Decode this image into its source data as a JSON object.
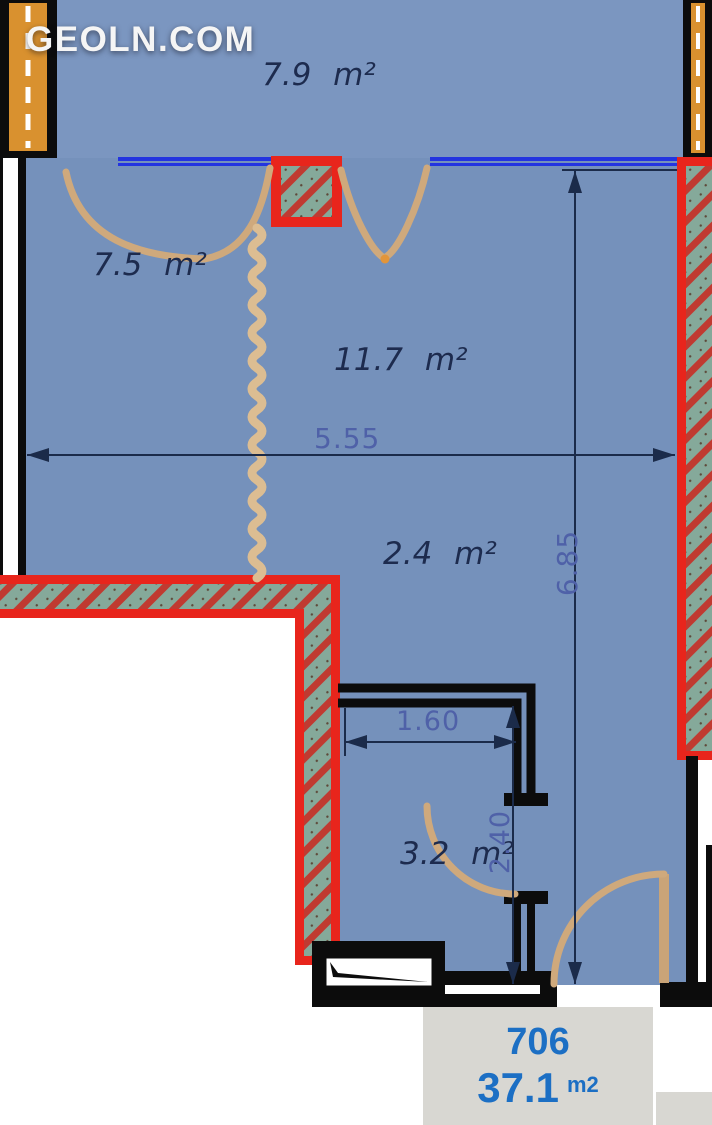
{
  "watermark": "GEOLN.COM",
  "rooms": [
    {
      "name": "balcony",
      "label": "7.9 m²"
    },
    {
      "name": "room-left",
      "label": "7.5 m²"
    },
    {
      "name": "living",
      "label": "11.7 m²"
    },
    {
      "name": "hallway",
      "label": "2.4 m²"
    },
    {
      "name": "bathroom",
      "label": "3.2 m²"
    }
  ],
  "dimensions": {
    "overall_width": "5.55",
    "overall_height": "6.85",
    "bath_width": "1.60",
    "bath_height": "2.40"
  },
  "unit_label": {
    "number": "706",
    "area": "37.1",
    "area_unit": "m2"
  },
  "icons": {
    "squiggle_partition": "squiggle-partition-line",
    "column": "structural-column",
    "window": "window-double-line"
  },
  "colors": {
    "floor_blue": "#7591bb",
    "wall_hatch_teal": "#85a99a",
    "wall_hatch_stripe": "#c03a31",
    "wall_red_border": "#e8251c",
    "wall_orange": "#d9912f",
    "window_blue": "#2334e0",
    "dimension_navy": "#1b2b4a",
    "dimension_blue_text": "#4f61a8",
    "tan_doors": "#cfa97c",
    "label_box_bg": "#d8d7d2",
    "label_text_blue": "#1c6fc4",
    "watermark_white": "#f5f5f5"
  }
}
